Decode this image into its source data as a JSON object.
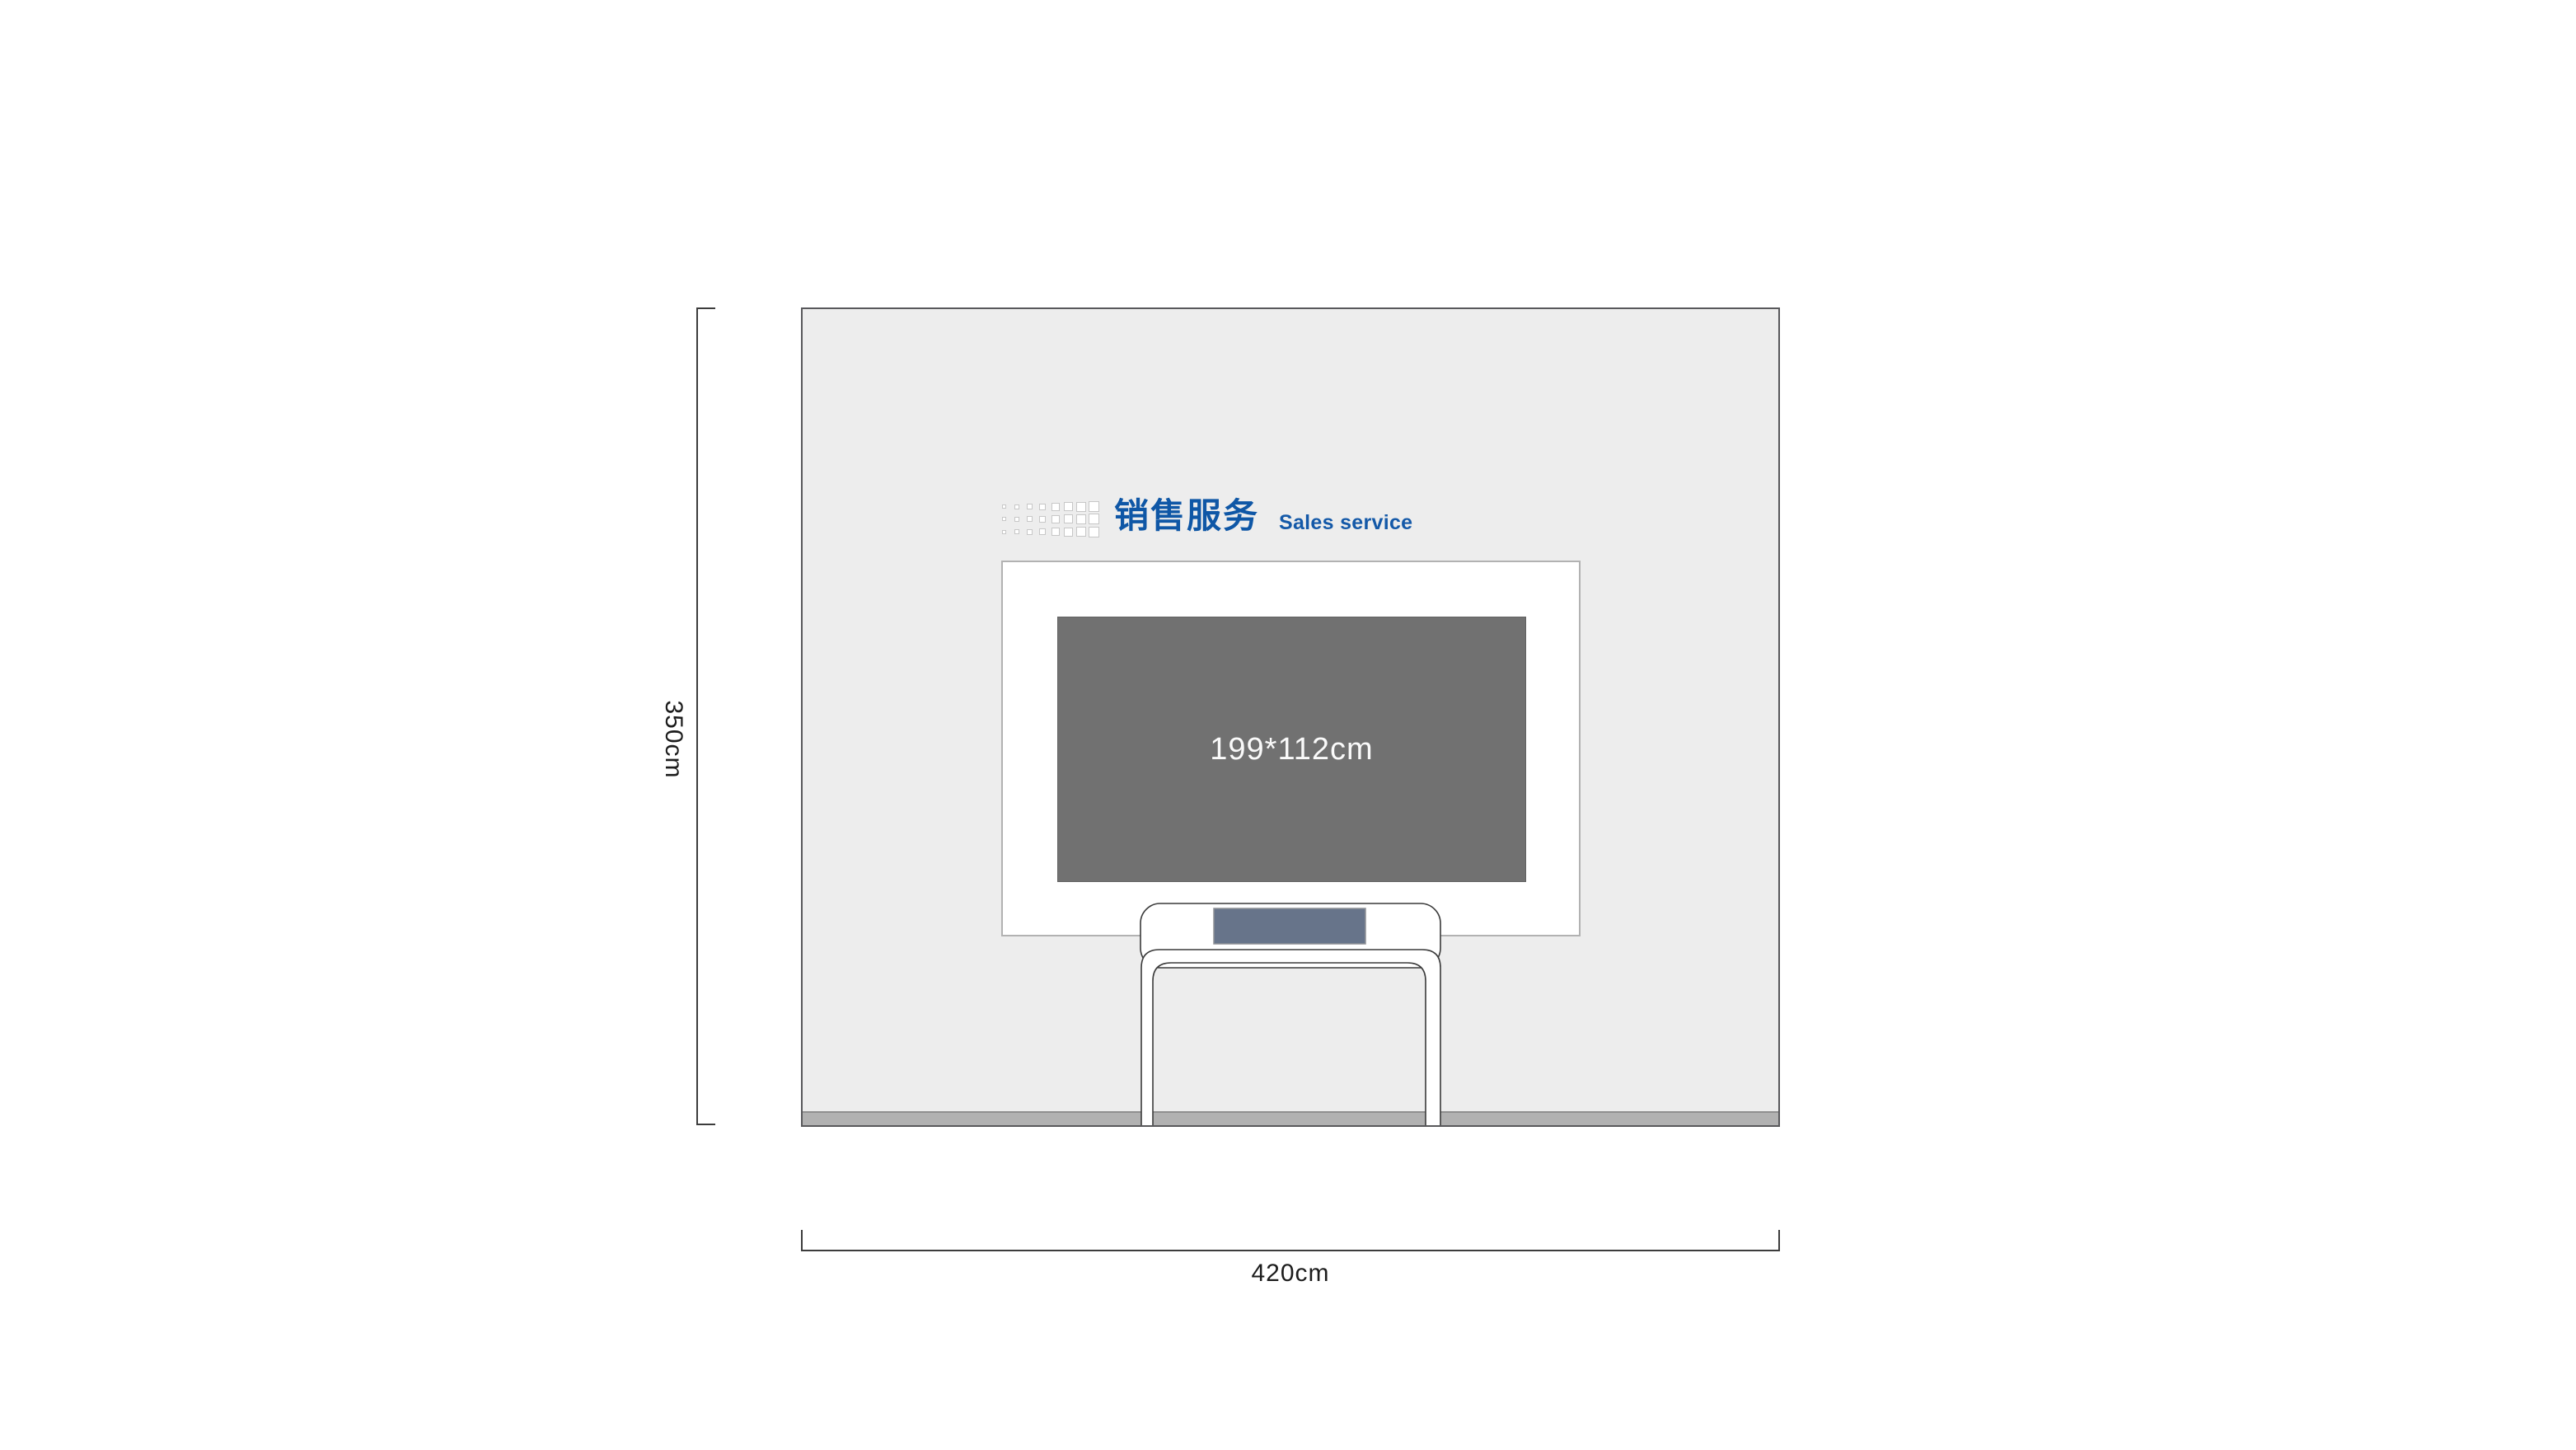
{
  "drawing": {
    "type": "wall-elevation",
    "heading": {
      "title_zh": "销售服务",
      "title_en": "Sales service",
      "text_color": "#0f57a6"
    },
    "wall": {
      "width_label": "420cm",
      "height_label": "350cm",
      "fill": "#ededed",
      "border_color": "#58585b",
      "baseboard_color": "#b1b1b1"
    },
    "display": {
      "size_label": "199*112cm",
      "fill": "#717171",
      "text_color": "#fafafa"
    },
    "table": {
      "top_fill": "#ffffff",
      "outline_color": "#3a3a3a",
      "screen_fill": "#67748a",
      "screen_border": "#8f9196"
    },
    "logo_grid": {
      "rows": 3,
      "cols": 8,
      "sizes": [
        5,
        6,
        7,
        8,
        10,
        11,
        12,
        13
      ],
      "square_color": "#ffffff",
      "border_color": "#c7c7c7"
    }
  }
}
